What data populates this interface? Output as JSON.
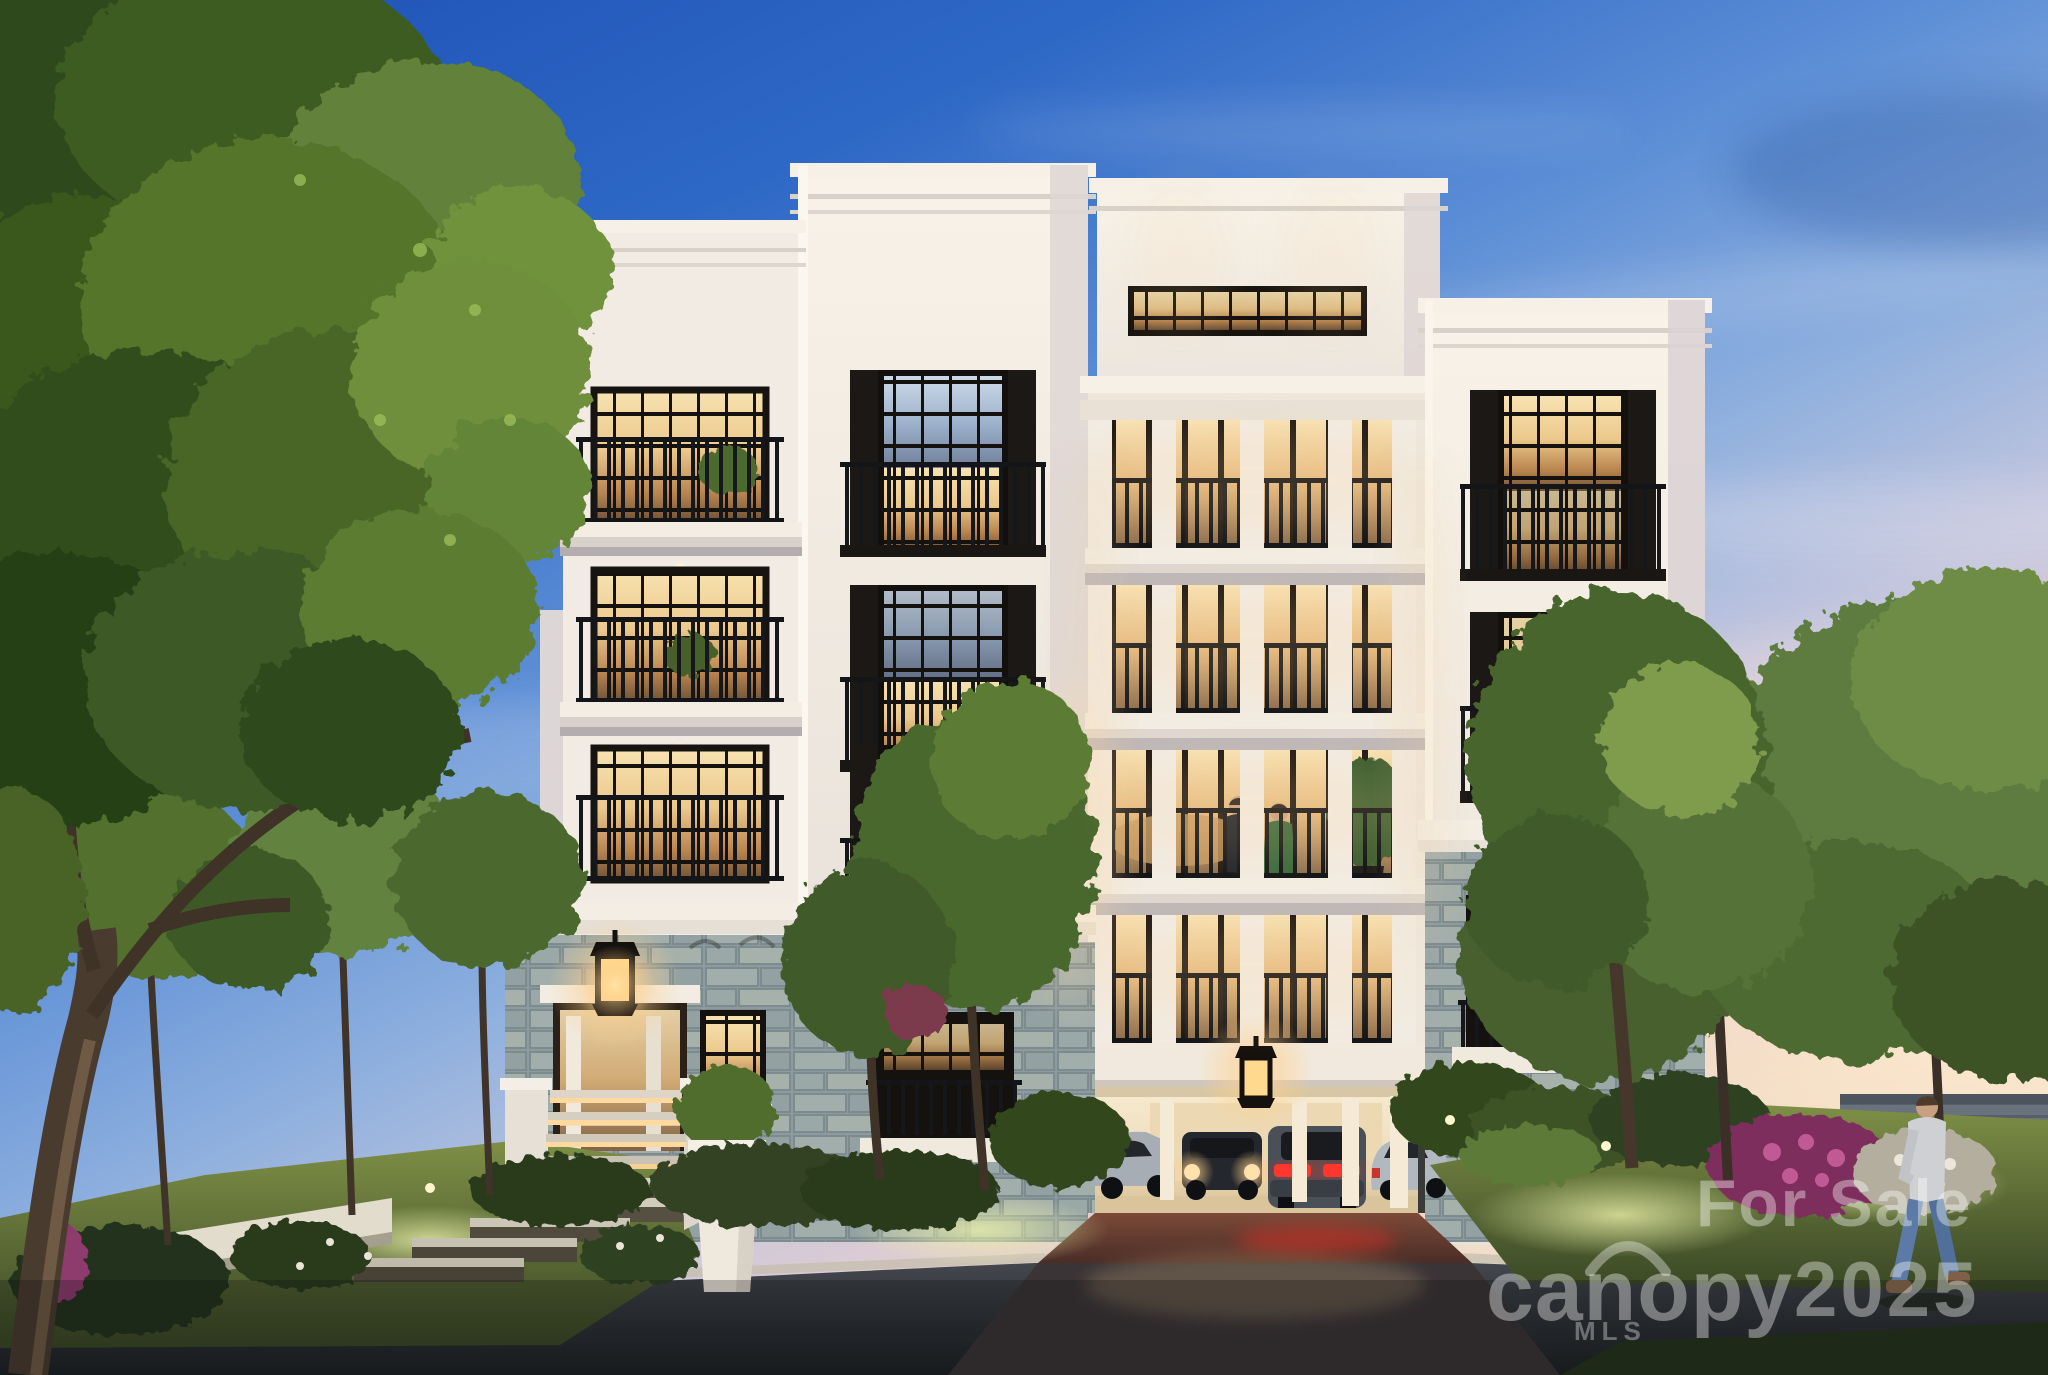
{
  "meta": {
    "type": "real-estate-listing-photo",
    "description": "Dusk architectural rendering of a new five-story luxury condominium building with white classical facade, black-framed lit windows, colonnaded balconies, grey stone base with drive-under parking garage, landscaped lawn, stone entry stair with lantern, mature trees and a man walking along the street."
  },
  "watermarks": {
    "for_sale": "For Sale",
    "brand": "canopy",
    "brand_sub": "MLS",
    "year": "2025",
    "color": "rgba(255,255,255,0.38)"
  },
  "scene": {
    "time_of_day": "dusk",
    "people": [
      "couple standing on third-floor colonnade balcony",
      "man walking on right lawn"
    ],
    "vehicles": [
      "silver sedan parked left",
      "dark SUV with headlights on",
      "red-taillight sedan entering garage",
      "silver sedan parked right"
    ],
    "building": {
      "stories": 5,
      "facade_color": "#f5efe6",
      "stone_color": "#97a4a6",
      "railing_color": "#17181b",
      "window_glow_color": "#f3d59c"
    }
  },
  "palette": {
    "sky_top": "#1c4fb3",
    "sky_mid": "#5c8ed6",
    "horizon_pink": "#e3cdd0",
    "horizon_peach": "#f3e4cf",
    "foliage_dark": "#2e4a1d",
    "foliage_light": "#6f8f3d",
    "lawn_lit": "#8fa04b",
    "asphalt": "#2b2f34",
    "paver": "#6b4134",
    "taillight": "#ff352c"
  }
}
